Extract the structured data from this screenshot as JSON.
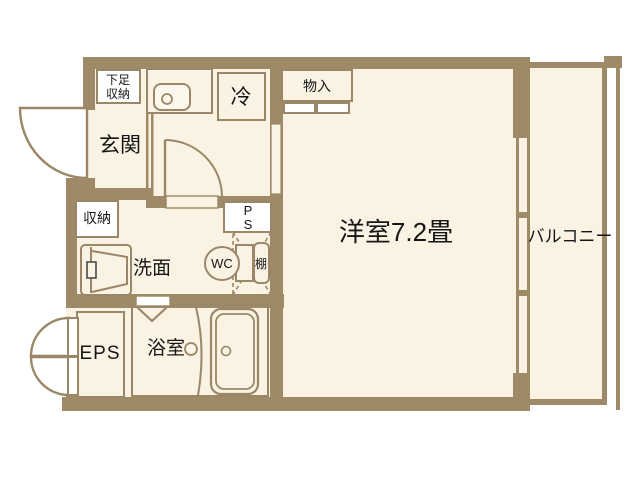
{
  "floorplan": {
    "title": "one-room apartment floor plan",
    "rooms": {
      "entrance": {
        "label": "玄関"
      },
      "shoe_storage": {
        "line1": "下足",
        "line2": "収納"
      },
      "refrigerator": {
        "label": "冷"
      },
      "closet": {
        "label": "物入"
      },
      "main_room": {
        "label": "洋室7.2畳"
      },
      "balcony": {
        "label": "バルコニー"
      },
      "storage": {
        "label": "収納"
      },
      "washroom": {
        "label": "洗面"
      },
      "pipe_space": {
        "line1": "P",
        "line2": "S"
      },
      "toilet": {
        "label": "WC"
      },
      "shelf": {
        "label": "棚"
      },
      "eps": {
        "label": "EPS"
      },
      "bathroom": {
        "label": "浴室"
      }
    },
    "colors": {
      "wall": "#9f8a68",
      "floor": "#faf2e3",
      "outline": "#9a8767",
      "fixture_white": "#ffffff",
      "text": "#161616",
      "background": "#ffffff"
    }
  }
}
